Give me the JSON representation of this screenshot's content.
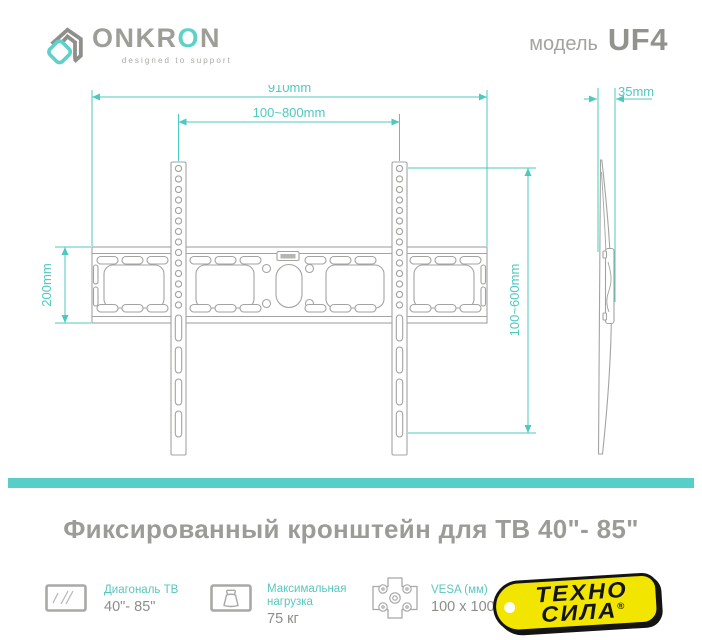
{
  "header": {
    "brand": {
      "part1": "ONKR",
      "accent": "O",
      "part2": "N"
    },
    "tagline": "designed to support",
    "model_label": "модель",
    "model_value": "UF4"
  },
  "diagram": {
    "total_width": "910mm",
    "hole_pattern_width": "100~800mm",
    "plate_height": "200mm",
    "hole_pattern_height": "100~600mm",
    "depth": "35mm"
  },
  "title": "Фиксированный кронштейн для ТВ 40\"- 85\"",
  "specs": [
    {
      "icon": "tv-diagonal-icon",
      "label": "Диагональ ТВ",
      "value": "40\"- 85\""
    },
    {
      "icon": "max-load-icon",
      "label": "Максимальная нагрузка",
      "value": "75 кг"
    },
    {
      "icon": "vesa-icon",
      "label": "VESA (мм)",
      "value": "100 x 100"
    }
  ],
  "retailer": {
    "name_line1": "ТЕХНО",
    "name_line2": "СИЛА",
    "reg_mark": "®"
  },
  "colors": {
    "accent_teal": "#4fc8c0",
    "drawing_gray": "#a3a3a0",
    "text_gray": "#9b9b97",
    "brand_yellow": "#f2e600"
  }
}
